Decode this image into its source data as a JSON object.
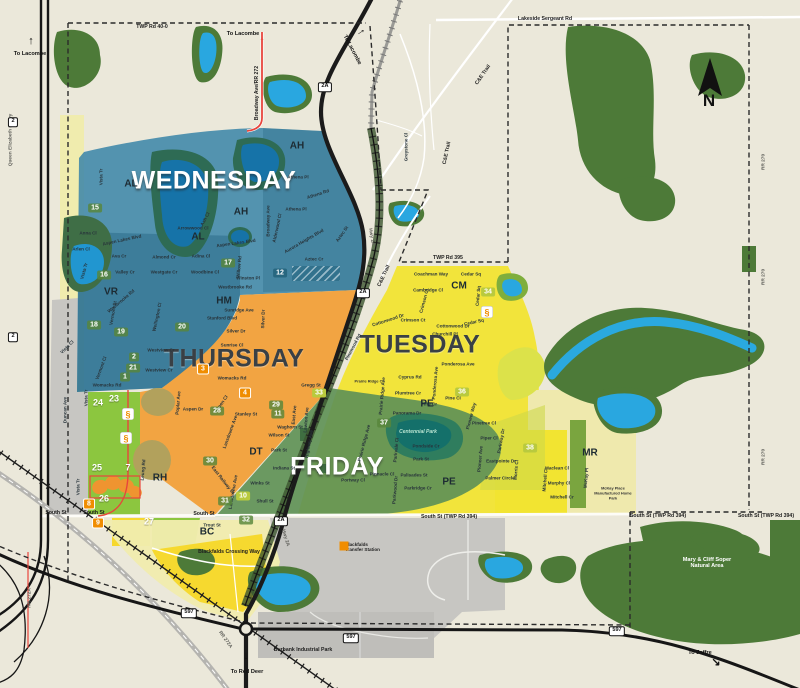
{
  "map": {
    "town": "Blackfalds collection zones map",
    "north_letter": "N",
    "colors": {
      "background": "#ebe8da",
      "park_green": "#4d7a38",
      "water_blue": "#29a7e0",
      "wednesday": "#3e86a8",
      "thursday": "#f1a13b",
      "tuesday": "#f2e331",
      "friday": "#5f9157",
      "lime_zone": "#8cc63f",
      "pale_yellow": "#f0ecae",
      "bright_yellow": "#f6d82e",
      "gray_zone": "#c7c6c2",
      "highway_black": "#1b1b1b",
      "road_red": "#e8453c",
      "badge_orange": "#f08d00",
      "badge_green": "#58863a",
      "badge_yellowgreen": "#b9ca3e",
      "badge_teal": "#26647c"
    },
    "zones": [
      {
        "name": "WEDNESDAY",
        "color": "#3e86a8",
        "x": 214,
        "y": 181,
        "style": "light"
      },
      {
        "name": "THURSDAY",
        "color": "#f1a13b",
        "x": 234,
        "y": 359,
        "style": "dark"
      },
      {
        "name": "TUESDAY",
        "color": "#f2e331",
        "x": 420,
        "y": 345,
        "style": "dark"
      },
      {
        "name": "FRIDAY",
        "color": "#5f9157",
        "x": 337,
        "y": 467,
        "style": "light"
      }
    ],
    "labels": [
      {
        "t": "TWP Rd 40-0",
        "x": 152,
        "y": 27,
        "c": "road"
      },
      {
        "t": "To Lacombe",
        "x": 30,
        "y": 54,
        "c": "to"
      },
      {
        "t": "To Lacombe",
        "x": 243,
        "y": 34,
        "c": "to"
      },
      {
        "t": "To Lacombe",
        "x": 352,
        "y": 50,
        "r": 62,
        "c": "to"
      },
      {
        "t": "Lakeside Sergeant Rd",
        "x": 545,
        "y": 19,
        "c": "road"
      },
      {
        "t": "Broadway Ave/RR 272",
        "x": 257,
        "y": 93,
        "r": -90,
        "c": "road"
      },
      {
        "t": "C&E Trail",
        "x": 483,
        "y": 75,
        "r": -55,
        "c": "road"
      },
      {
        "t": "C&E Trail",
        "x": 447,
        "y": 153,
        "r": -78,
        "c": "road"
      },
      {
        "t": "C&E Trail",
        "x": 384,
        "y": 276,
        "r": -65,
        "c": "road"
      },
      {
        "t": "Greystone Cl",
        "x": 406,
        "y": 147,
        "r": -90
      },
      {
        "t": "RR 270",
        "x": 764,
        "y": 162,
        "r": -90,
        "c": "edge"
      },
      {
        "t": "RR 270",
        "x": 764,
        "y": 277,
        "r": -90,
        "c": "edge"
      },
      {
        "t": "RR 270",
        "x": 764,
        "y": 457,
        "r": -90,
        "c": "edge"
      },
      {
        "t": "Queen Elizabeth II Hwy",
        "x": 11,
        "y": 140,
        "r": -90,
        "c": "edge"
      },
      {
        "t": "RR 272A",
        "x": 30,
        "y": 598,
        "r": -90,
        "c": "edge"
      },
      {
        "t": "RR 272A",
        "x": 225,
        "y": 640,
        "r": 55,
        "c": "edge"
      },
      {
        "t": "Hwy 2A",
        "x": 371,
        "y": 237,
        "r": 80,
        "c": "edge"
      },
      {
        "t": "Hwy 2A",
        "x": 285,
        "y": 538,
        "r": 73,
        "c": "edge"
      },
      {
        "t": "TWP Rd 395",
        "x": 448,
        "y": 258,
        "c": "road"
      },
      {
        "t": "South St (TWP Rd 394)",
        "x": 449,
        "y": 517,
        "c": "road"
      },
      {
        "t": "South St (TWP Rd 394)",
        "x": 658,
        "y": 516,
        "c": "road"
      },
      {
        "t": "South St (TWP Rd 394)",
        "x": 766,
        "y": 516,
        "c": "road"
      },
      {
        "t": "South St",
        "x": 56,
        "y": 513,
        "c": "road"
      },
      {
        "t": "South St",
        "x": 94,
        "y": 513,
        "c": "road"
      },
      {
        "t": "South St",
        "x": 204,
        "y": 514,
        "c": "road"
      },
      {
        "t": "Blackfalds Crossing Way",
        "x": 229,
        "y": 552,
        "c": "road"
      },
      {
        "t": "Burbank Industrial Park",
        "x": 303,
        "y": 650,
        "c": "road"
      },
      {
        "t": "To Red Deer",
        "x": 247,
        "y": 672,
        "c": "to"
      },
      {
        "t": "To Joffre",
        "x": 700,
        "y": 653,
        "c": "to"
      },
      {
        "t": "Mary & Cliff Soper Natural Area",
        "x": 707,
        "y": 563,
        "c": "toW"
      },
      {
        "t": "Blackfalds Transfer Station",
        "x": 366,
        "y": 547,
        "c": "tiny2"
      },
      {
        "t": "McKay Place Manufactured Home Park",
        "x": 613,
        "y": 493,
        "c": "tiny"
      },
      {
        "t": "AH",
        "x": 297,
        "y": 146,
        "c": "nb"
      },
      {
        "t": "AH",
        "x": 241,
        "y": 212,
        "c": "nb"
      },
      {
        "t": "AL",
        "x": 131,
        "y": 184,
        "c": "nb"
      },
      {
        "t": "AL",
        "x": 198,
        "y": 237,
        "c": "nb"
      },
      {
        "t": "VR",
        "x": 111,
        "y": 292,
        "c": "nb"
      },
      {
        "t": "HM",
        "x": 224,
        "y": 301,
        "c": "nb"
      },
      {
        "t": "CM",
        "x": 459,
        "y": 286,
        "c": "nb"
      },
      {
        "t": "DT",
        "x": 256,
        "y": 452,
        "c": "nb"
      },
      {
        "t": "PE",
        "x": 427,
        "y": 404,
        "c": "nb"
      },
      {
        "t": "PE",
        "x": 449,
        "y": 482,
        "c": "nb"
      },
      {
        "t": "RH",
        "x": 160,
        "y": 478,
        "c": "nb"
      },
      {
        "t": "MR",
        "x": 590,
        "y": 453,
        "c": "nb"
      },
      {
        "t": "BC",
        "x": 207,
        "y": 532,
        "c": "nb"
      },
      {
        "t": "Vista Tr",
        "x": 101,
        "y": 177,
        "r": -90
      },
      {
        "t": "Anna Cl",
        "x": 88,
        "y": 233
      },
      {
        "t": "Arlen Cl",
        "x": 81,
        "y": 249
      },
      {
        "t": "Ava Cr",
        "x": 119,
        "y": 256
      },
      {
        "t": "Aspen Lakes Blvd",
        "x": 122,
        "y": 240,
        "r": -12
      },
      {
        "t": "Aspen Lakes Blvd",
        "x": 236,
        "y": 243,
        "r": -8
      },
      {
        "t": "Valley Cr",
        "x": 125,
        "y": 272
      },
      {
        "t": "Westgate Cr",
        "x": 164,
        "y": 272
      },
      {
        "t": "Almond Cr",
        "x": 164,
        "y": 257
      },
      {
        "t": "Adina Cl",
        "x": 201,
        "y": 256
      },
      {
        "t": "Woodbine Cl",
        "x": 205,
        "y": 272
      },
      {
        "t": "Arrowwood Cl",
        "x": 193,
        "y": 228
      },
      {
        "t": "Ash Cl",
        "x": 205,
        "y": 219,
        "r": -62
      },
      {
        "t": "Athena Pl",
        "x": 298,
        "y": 177
      },
      {
        "t": "Athena Rd",
        "x": 318,
        "y": 194,
        "r": -18
      },
      {
        "t": "Athena Pl",
        "x": 296,
        "y": 209
      },
      {
        "t": "Alderwood Cl",
        "x": 277,
        "y": 228,
        "r": -78
      },
      {
        "t": "Aurora Heights Blvd",
        "x": 304,
        "y": 241,
        "r": -30
      },
      {
        "t": "Aztec St",
        "x": 342,
        "y": 234,
        "r": -55
      },
      {
        "t": "Aztec Cr",
        "x": 314,
        "y": 259
      },
      {
        "t": "Willow Rd",
        "x": 239,
        "y": 267,
        "r": -85
      },
      {
        "t": "Winston Pl",
        "x": 248,
        "y": 278
      },
      {
        "t": "Westbrooke Rd",
        "x": 235,
        "y": 287
      },
      {
        "t": "Westbrooke Rd",
        "x": 121,
        "y": 301,
        "r": -40
      },
      {
        "t": "Broadway Ave",
        "x": 268,
        "y": 221,
        "r": -90
      },
      {
        "t": "Vista Cl",
        "x": 67,
        "y": 347,
        "r": -45
      },
      {
        "t": "Vista Tr",
        "x": 84,
        "y": 271,
        "r": -75
      },
      {
        "t": "Vermont St",
        "x": 113,
        "y": 313,
        "r": -80
      },
      {
        "t": "Vermont Cl",
        "x": 101,
        "y": 368,
        "r": -70
      },
      {
        "t": "Wellington Cl",
        "x": 157,
        "y": 317,
        "r": -78
      },
      {
        "t": "Womacks Rd",
        "x": 107,
        "y": 385
      },
      {
        "t": "Womacks Rd",
        "x": 232,
        "y": 378
      },
      {
        "t": "Sunridge Ave",
        "x": 239,
        "y": 310
      },
      {
        "t": "Stanford Blvd",
        "x": 222,
        "y": 318
      },
      {
        "t": "Silver Dr",
        "x": 236,
        "y": 331
      },
      {
        "t": "Silver Dr",
        "x": 263,
        "y": 319,
        "r": -88
      },
      {
        "t": "Sunrise Cl",
        "x": 232,
        "y": 345
      },
      {
        "t": "Westview Cr",
        "x": 161,
        "y": 350
      },
      {
        "t": "Westview Cr",
        "x": 159,
        "y": 370
      },
      {
        "t": "Gregg St",
        "x": 311,
        "y": 385
      },
      {
        "t": "Aspen Dr",
        "x": 193,
        "y": 409
      },
      {
        "t": "Aspen Cl",
        "x": 221,
        "y": 404,
        "r": -55
      },
      {
        "t": "Poplar Ave",
        "x": 178,
        "y": 403,
        "r": -85
      },
      {
        "t": "Stanley St",
        "x": 246,
        "y": 414
      },
      {
        "t": "Lansdowne Ave",
        "x": 230,
        "y": 432,
        "r": -70
      },
      {
        "t": "Leung Rd",
        "x": 143,
        "y": 470,
        "r": -85
      },
      {
        "t": "Coachman Way",
        "x": 431,
        "y": 274
      },
      {
        "t": "Cedar Sq",
        "x": 471,
        "y": 274
      },
      {
        "t": "Cambridge Cl",
        "x": 428,
        "y": 290
      },
      {
        "t": "Crimson Cl",
        "x": 424,
        "y": 301,
        "r": -75
      },
      {
        "t": "Crimson Ct",
        "x": 413,
        "y": 320
      },
      {
        "t": "Cottonwood Dr",
        "x": 453,
        "y": 326
      },
      {
        "t": "Cottonwood Dr",
        "x": 388,
        "y": 320,
        "r": -18
      },
      {
        "t": "Cedar Sq",
        "x": 474,
        "y": 322,
        "r": -12
      },
      {
        "t": "Cedar Sq",
        "x": 478,
        "y": 296,
        "r": -85
      },
      {
        "t": "Churchill Pl",
        "x": 445,
        "y": 334
      },
      {
        "t": "Ponderosa Ave",
        "x": 458,
        "y": 364
      },
      {
        "t": "Ponderosa Ave",
        "x": 435,
        "y": 383,
        "r": -85
      },
      {
        "t": "Cyprus Rd",
        "x": 410,
        "y": 377
      },
      {
        "t": "Plumtree Cr",
        "x": 408,
        "y": 393
      },
      {
        "t": "Prairie Ridge Cl",
        "x": 369,
        "y": 381,
        "c": "tiny"
      },
      {
        "t": "Prairie Ridge Ave",
        "x": 382,
        "y": 396,
        "r": -85
      },
      {
        "t": "Pinewood Rd",
        "x": 353,
        "y": 347,
        "r": -62
      },
      {
        "t": "Pine Cr",
        "x": 429,
        "y": 404
      },
      {
        "t": "Pine Cl",
        "x": 453,
        "y": 398
      },
      {
        "t": "Pioneer Way",
        "x": 471,
        "y": 416,
        "r": -75
      },
      {
        "t": "Pinetree Cl",
        "x": 484,
        "y": 423
      },
      {
        "t": "Piper Cl",
        "x": 489,
        "y": 438
      },
      {
        "t": "Pioneer Ave",
        "x": 480,
        "y": 459,
        "r": -85
      },
      {
        "t": "Parkway Dr",
        "x": 501,
        "y": 441,
        "r": -80
      },
      {
        "t": "Eastpointe Dr",
        "x": 501,
        "y": 461
      },
      {
        "t": "Palmer Circle",
        "x": 500,
        "y": 478
      },
      {
        "t": "Morris Cl",
        "x": 516,
        "y": 470,
        "r": -85
      },
      {
        "t": "Maclean Cl",
        "x": 557,
        "y": 468
      },
      {
        "t": "Murphy Cl",
        "x": 559,
        "y": 483
      },
      {
        "t": "Mitchell Cr",
        "x": 562,
        "y": 497
      },
      {
        "t": "Mitchell Cl",
        "x": 545,
        "y": 480,
        "r": -85
      },
      {
        "t": "McKay Pl",
        "x": 586,
        "y": 478,
        "r": -85
      },
      {
        "t": "Panorama Dr",
        "x": 407,
        "y": 413
      },
      {
        "t": "Centennial Park",
        "x": 418,
        "y": 432,
        "c": "park"
      },
      {
        "t": "Pondside Cr",
        "x": 426,
        "y": 446
      },
      {
        "t": "Park St",
        "x": 421,
        "y": 459
      },
      {
        "t": "Palisades St",
        "x": 414,
        "y": 475
      },
      {
        "t": "Parkridge Cr",
        "x": 418,
        "y": 488
      },
      {
        "t": "Pinnacle Cl",
        "x": 382,
        "y": 474
      },
      {
        "t": "Portway Cl",
        "x": 353,
        "y": 480
      },
      {
        "t": "Parkvale Cl",
        "x": 396,
        "y": 450,
        "r": -85
      },
      {
        "t": "Parkwood Dr",
        "x": 395,
        "y": 490,
        "r": -85
      },
      {
        "t": "Prairie Ridge Ave",
        "x": 364,
        "y": 443,
        "r": -75
      },
      {
        "t": "Waghorn St",
        "x": 290,
        "y": 427
      },
      {
        "t": "Wilson St",
        "x": 279,
        "y": 435
      },
      {
        "t": "Park St",
        "x": 279,
        "y": 450
      },
      {
        "t": "Indiana St",
        "x": 284,
        "y": 468
      },
      {
        "t": "Winks St",
        "x": 260,
        "y": 483
      },
      {
        "t": "Shull St",
        "x": 265,
        "y": 501
      },
      {
        "t": "Highway Ave",
        "x": 309,
        "y": 444,
        "r": -80
      },
      {
        "t": "East Ave",
        "x": 294,
        "y": 415,
        "r": -85
      },
      {
        "t": "Lawton Ave",
        "x": 306,
        "y": 420,
        "r": -85
      },
      {
        "t": "Lansdowne Ave",
        "x": 233,
        "y": 492,
        "r": -80
      },
      {
        "t": "East Railway St",
        "x": 223,
        "y": 480,
        "r": 52
      },
      {
        "t": "Trout St",
        "x": 212,
        "y": 525
      },
      {
        "t": "Vista Tr",
        "x": 78,
        "y": 487,
        "r": -90
      },
      {
        "t": "Vista Tr",
        "x": 86,
        "y": 398,
        "r": -90
      },
      {
        "t": "Duncan Ave",
        "x": 65,
        "y": 410,
        "r": -90
      }
    ],
    "badges": [
      {
        "n": "15",
        "x": 95,
        "y": 208,
        "c": "g"
      },
      {
        "n": "16",
        "x": 104,
        "y": 275,
        "c": "g"
      },
      {
        "n": "17",
        "x": 228,
        "y": 263,
        "c": "g"
      },
      {
        "n": "18",
        "x": 94,
        "y": 325,
        "c": "g"
      },
      {
        "n": "19",
        "x": 121,
        "y": 332,
        "c": "g"
      },
      {
        "n": "12",
        "x": 280,
        "y": 273,
        "c": "t"
      },
      {
        "n": "20",
        "x": 182,
        "y": 327,
        "c": "g"
      },
      {
        "n": "2",
        "x": 134,
        "y": 357,
        "c": "g"
      },
      {
        "n": "21",
        "x": 133,
        "y": 368,
        "c": "g"
      },
      {
        "n": "1",
        "x": 125,
        "y": 377,
        "c": "g"
      },
      {
        "n": "3",
        "x": 203,
        "y": 369,
        "c": "o"
      },
      {
        "n": "4",
        "x": 245,
        "y": 393,
        "c": "o"
      },
      {
        "n": "28",
        "x": 217,
        "y": 411,
        "c": "g"
      },
      {
        "n": "29",
        "x": 276,
        "y": 405,
        "c": "g"
      },
      {
        "n": "11",
        "x": 278,
        "y": 414,
        "c": "g"
      },
      {
        "n": "33",
        "x": 319,
        "y": 393,
        "c": "y"
      },
      {
        "n": "30",
        "x": 210,
        "y": 461,
        "c": "g"
      },
      {
        "n": "31",
        "x": 225,
        "y": 501,
        "c": "g"
      },
      {
        "n": "10",
        "x": 243,
        "y": 496,
        "c": "y"
      },
      {
        "n": "32",
        "x": 246,
        "y": 520,
        "c": "g"
      },
      {
        "n": "24",
        "x": 98,
        "y": 403,
        "c": "p"
      },
      {
        "n": "23",
        "x": 114,
        "y": 399,
        "c": "p"
      },
      {
        "n": "25",
        "x": 97,
        "y": 468,
        "c": "p"
      },
      {
        "n": "7",
        "x": 128,
        "y": 468,
        "c": "p"
      },
      {
        "n": "26",
        "x": 104,
        "y": 499,
        "c": "p"
      },
      {
        "n": "8",
        "x": 89,
        "y": 504,
        "c": "o"
      },
      {
        "n": "9",
        "x": 98,
        "y": 523,
        "c": "o"
      },
      {
        "n": "27",
        "x": 149,
        "y": 522,
        "c": "p"
      },
      {
        "n": "34",
        "x": 488,
        "y": 292,
        "c": "y"
      },
      {
        "n": "36",
        "x": 462,
        "y": 392,
        "c": "y"
      },
      {
        "n": "37",
        "x": 384,
        "y": 423,
        "c": "g"
      },
      {
        "n": "38",
        "x": 530,
        "y": 448,
        "c": "y"
      }
    ],
    "shields": [
      {
        "t": "2",
        "x": 13,
        "y": 122
      },
      {
        "t": "2",
        "x": 13,
        "y": 337
      },
      {
        "t": "2A",
        "x": 325,
        "y": 87
      },
      {
        "t": "2A",
        "x": 363,
        "y": 293
      },
      {
        "t": "2A",
        "x": 281,
        "y": 521
      },
      {
        "t": "597",
        "x": 189,
        "y": 613
      },
      {
        "t": "597",
        "x": 351,
        "y": 638
      },
      {
        "t": "597",
        "x": 617,
        "y": 631
      }
    ],
    "icons": [
      {
        "kind": "school-icon",
        "x": 128,
        "y": 414
      },
      {
        "kind": "school-icon",
        "x": 126,
        "y": 438
      },
      {
        "kind": "school-icon",
        "x": 487,
        "y": 312
      },
      {
        "kind": "transfer-station-icon",
        "x": 344,
        "y": 546
      }
    ],
    "school_glyph": "§",
    "arrows": [
      {
        "g": "↑",
        "x": 31,
        "y": 41,
        "red": false
      },
      {
        "g": "↑",
        "x": 262,
        "y": 41,
        "red": true
      },
      {
        "g": "↑",
        "x": 361,
        "y": 32,
        "r": 55,
        "red": false
      },
      {
        "g": "↓",
        "x": 246,
        "y": 656,
        "red": false
      },
      {
        "g": "↘",
        "x": 716,
        "y": 662,
        "red": false
      }
    ],
    "north": {
      "letter": "N",
      "x": 709,
      "y": 101
    }
  }
}
